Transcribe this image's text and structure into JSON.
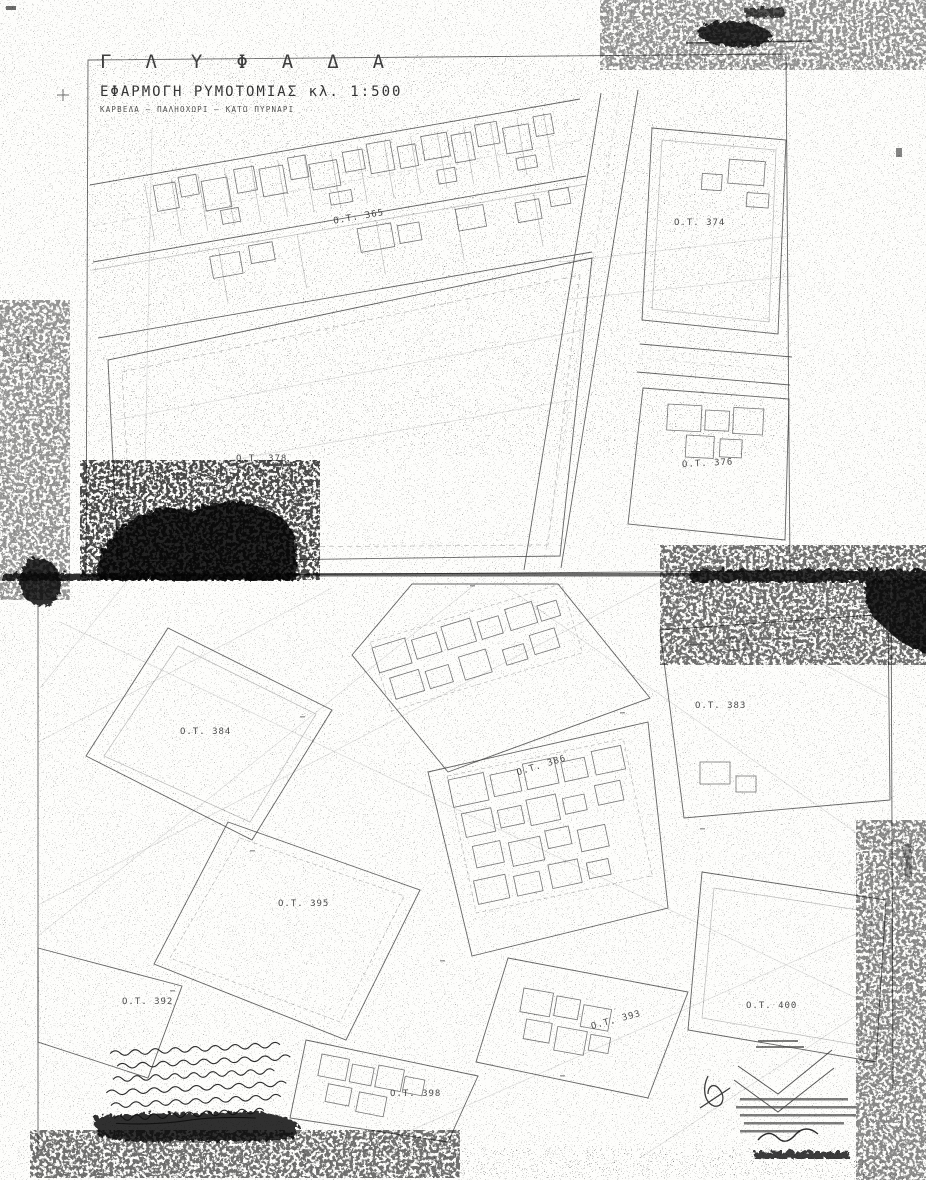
{
  "document": {
    "title": "ΓΛΥΦΑΔΑ",
    "subtitle": "ΕΦΑΡΜΟΓΗ ΡΥΜΟΤΟΜΙΑΣ κλ. 1:500",
    "area_line": "ΚΑΡΒΕΛΑ – ΠΑΛΗΟΧΩΡΙ – ΚΑΤΩ ΠΥΡΝΑΡΙ",
    "scale": "1:500"
  },
  "map": {
    "blocks": [
      {
        "id": "ot-365",
        "label": "Ο.Τ. 365"
      },
      {
        "id": "ot-374",
        "label": "Ο.Τ. 374"
      },
      {
        "id": "ot-378",
        "label": "Ο.Τ. 378"
      },
      {
        "id": "ot-376",
        "label": "Ο.Τ. 376"
      },
      {
        "id": "ot-383",
        "label": "Ο.Τ. 383"
      },
      {
        "id": "ot-384",
        "label": "Ο.Τ. 384"
      },
      {
        "id": "ot-386",
        "label": "Ο.Τ. 386"
      },
      {
        "id": "ot-395",
        "label": "Ο.Τ. 395"
      },
      {
        "id": "ot-392",
        "label": "Ο.Τ. 392"
      },
      {
        "id": "ot-393",
        "label": "Ο.Τ. 393"
      },
      {
        "id": "ot-400",
        "label": "Ο.Τ. 400"
      },
      {
        "id": "ot-398",
        "label": "Ο.Τ. 398"
      }
    ],
    "colors": {
      "paper": "#fdfdfb",
      "ink": "#1c1c1c",
      "faint_line": "#8b8b8b"
    }
  }
}
